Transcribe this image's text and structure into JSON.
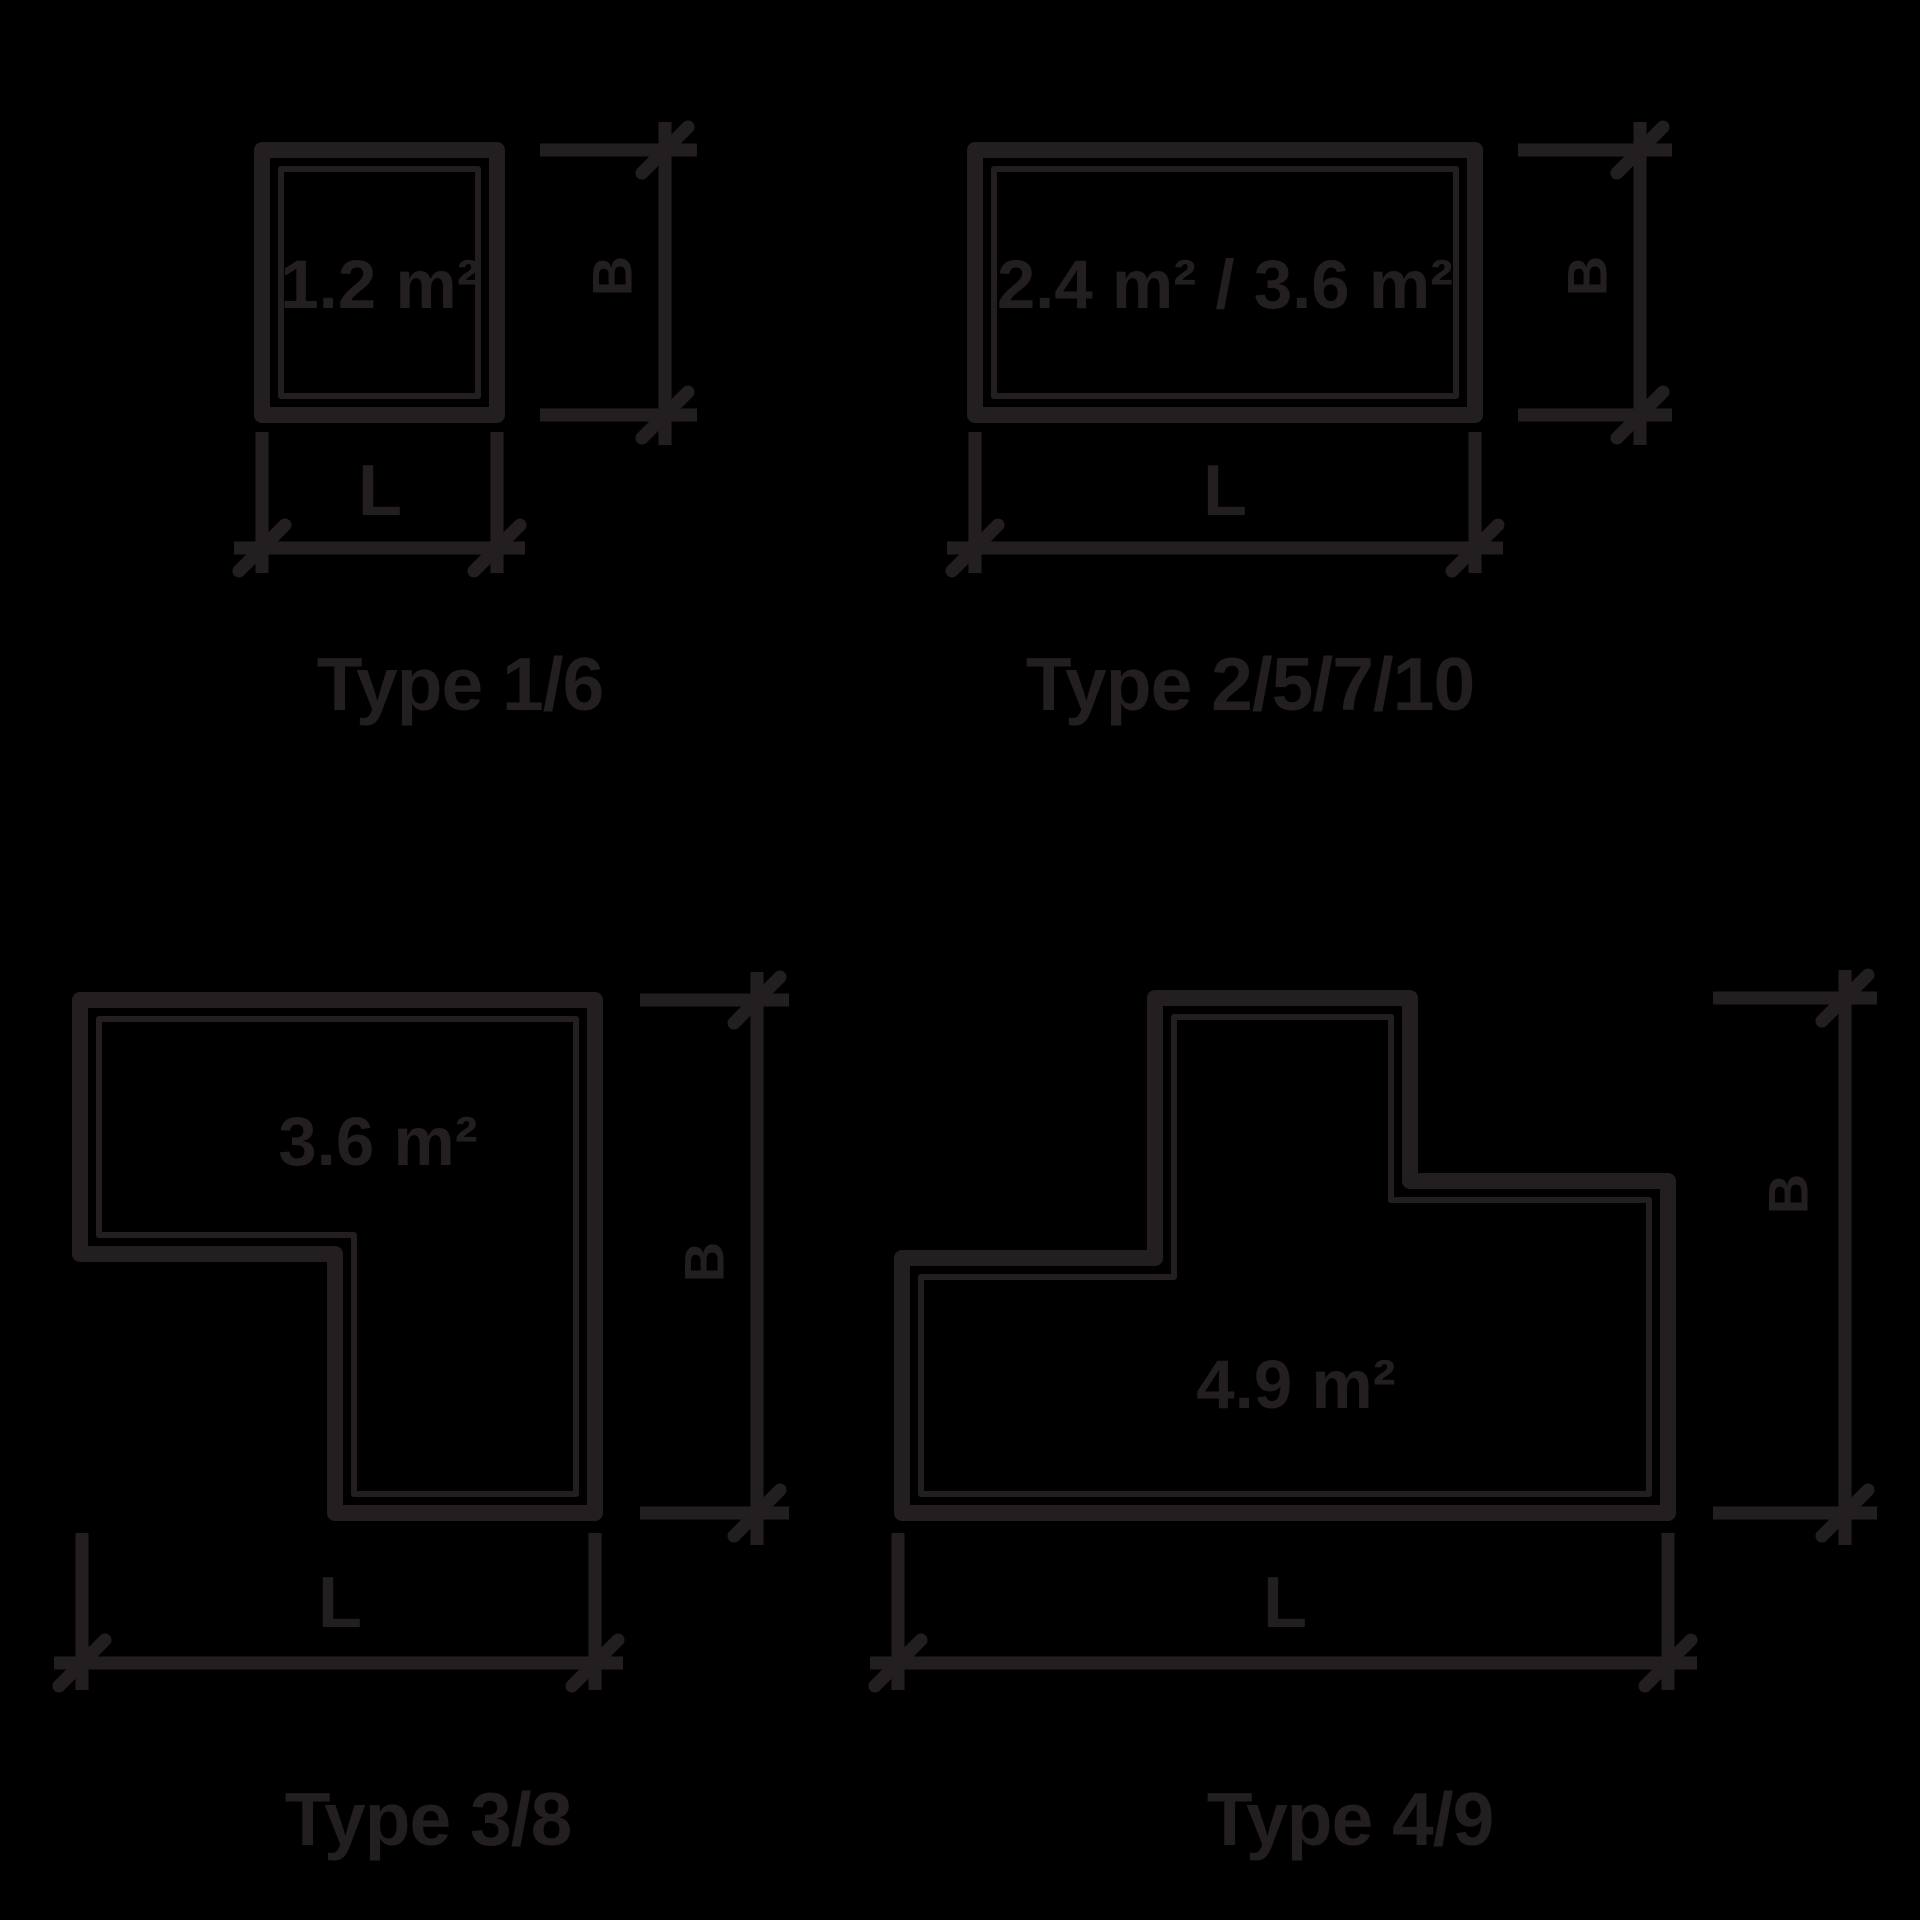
{
  "canvas": {
    "width": 1920,
    "height": 1920,
    "background": "#000000",
    "ink": "#231f20"
  },
  "diagrams": [
    {
      "shape": "square",
      "area_label": "1.2 m²",
      "height_label": "B",
      "width_label": "L",
      "caption": "Type 1/6"
    },
    {
      "shape": "wide-rectangle",
      "area_label": "2.4 m² / 3.6 m²",
      "height_label": "B",
      "width_label": "L",
      "caption": "Type 2/5/7/10"
    },
    {
      "shape": "l-shape",
      "area_label": "3.6 m²",
      "height_label": "B",
      "width_label": "L",
      "caption": "Type 3/8"
    },
    {
      "shape": "t-shape",
      "area_label": "4.9 m²",
      "height_label": "B",
      "width_label": "L",
      "caption": "Type 4/9"
    }
  ]
}
